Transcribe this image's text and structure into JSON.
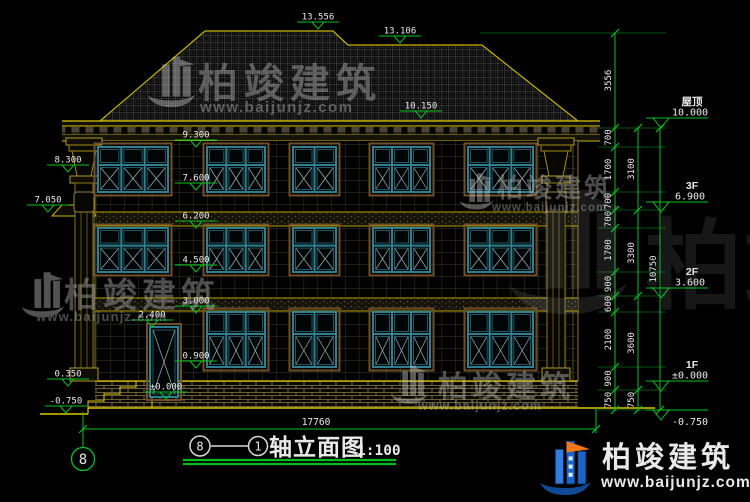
{
  "title": {
    "axis_from": "8",
    "axis_to": "1",
    "name": "轴立面图",
    "scale": "1:100"
  },
  "axis_bubble_label": "8",
  "total_width": "17760",
  "brand": {
    "name": "柏竣建筑",
    "url": "www.baijunjz.com"
  },
  "colors": {
    "green": "#00c41e",
    "yellow": "#c8b400",
    "bright_yellow": "#ddc800",
    "teal": "#2e8090",
    "teal_dark": "#1d5864",
    "trim": "#6e4f28",
    "white": "#e9e9e9",
    "logo_blue": "#1a66c8",
    "logo_dark_blue": "#0f4a96",
    "logo_orange": "#f07818"
  },
  "levels": [
    {
      "label": "屋顶",
      "value": "10.000",
      "y": 118
    },
    {
      "label": "3F",
      "value": "6.900",
      "y": 202
    },
    {
      "label": "2F",
      "value": "3.600",
      "y": 288
    },
    {
      "label": "1F",
      "value": "±0.000",
      "y": 381
    },
    {
      "label": "",
      "value": "-0.750",
      "y": 410
    }
  ],
  "markers": [
    {
      "v": "13.556",
      "x": 318,
      "y": 22
    },
    {
      "v": "13.106",
      "x": 400,
      "y": 36
    },
    {
      "v": "10.150",
      "x": 421,
      "y": 111
    },
    {
      "v": "9.300",
      "x": 196,
      "y": 140
    },
    {
      "v": "7.600",
      "x": 196,
      "y": 183
    },
    {
      "v": "6.200",
      "x": 196,
      "y": 221
    },
    {
      "v": "4.500",
      "x": 196,
      "y": 265
    },
    {
      "v": "3.000",
      "x": 196,
      "y": 306
    },
    {
      "v": "0.900",
      "x": 196,
      "y": 361
    },
    {
      "v": "2.400",
      "x": 152,
      "y": 320
    },
    {
      "v": "±0.000",
      "x": 166,
      "y": 392
    },
    {
      "v": "8.300",
      "x": 68,
      "y": 165
    },
    {
      "v": "7.050",
      "x": 48,
      "y": 205
    },
    {
      "v": "0.350",
      "x": 68,
      "y": 379
    },
    {
      "v": "-0.750",
      "x": 66,
      "y": 406
    }
  ],
  "dim_chains": [
    {
      "x": 615,
      "segs": [
        {
          "v": "3556",
          "y1": 33,
          "y2": 128
        },
        {
          "v": "700",
          "y1": 128,
          "y2": 147
        },
        {
          "v": "1700",
          "y1": 147,
          "y2": 192
        },
        {
          "v": "700",
          "y1": 192,
          "y2": 210
        },
        {
          "v": "700",
          "y1": 210,
          "y2": 228
        },
        {
          "v": "1700",
          "y1": 228,
          "y2": 272
        },
        {
          "v": "900",
          "y1": 272,
          "y2": 296
        },
        {
          "v": "600",
          "y1": 296,
          "y2": 312
        },
        {
          "v": "2100",
          "y1": 312,
          "y2": 367
        },
        {
          "v": "900",
          "y1": 367,
          "y2": 390
        },
        {
          "v": "750",
          "y1": 390,
          "y2": 410
        }
      ]
    },
    {
      "x": 638,
      "segs": [
        {
          "v": "3100",
          "y1": 128,
          "y2": 210
        },
        {
          "v": "3300",
          "y1": 210,
          "y2": 296
        },
        {
          "v": "3600",
          "y1": 296,
          "y2": 390
        },
        {
          "v": "750",
          "y1": 390,
          "y2": 410
        }
      ]
    },
    {
      "x": 660,
      "segs": [
        {
          "v": "10750",
          "y1": 128,
          "y2": 410
        }
      ]
    }
  ]
}
